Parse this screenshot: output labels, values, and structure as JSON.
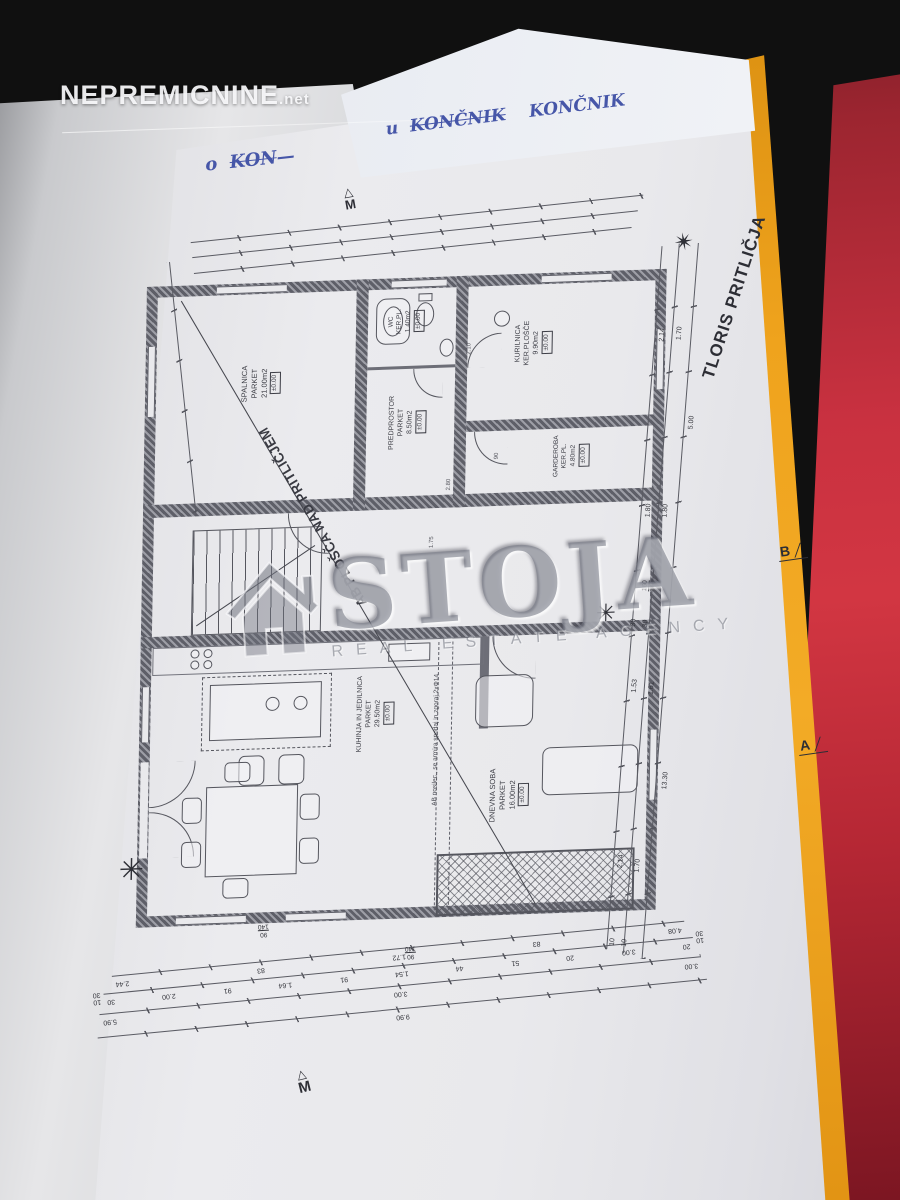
{
  "watermarks": {
    "nepremicnine": {
      "brand": "NEPREMICNINE",
      "suffix": ".net"
    },
    "stoja": {
      "brand": "STOJA",
      "subtitle": "REAL ESTATE AGENCY"
    }
  },
  "handwriting": {
    "mark1": "u",
    "word1_struck": "KONČNIK",
    "word2": "KONČNIK",
    "mark2": "o",
    "word3_struck": "KON"
  },
  "plan": {
    "title": "TLORIS PRITLIČJA",
    "diagonal_note": "AB PLOŠČA NAD PRITLIČJEM",
    "beam_note": "AB nosilec., se armira spodaj in zgoraj 2xΦ14",
    "north_symbol": "✴",
    "scale_letter": "M",
    "scale_triangle": "△",
    "section_b": "B",
    "section_a": "A",
    "rooms": [
      {
        "name": "SPALNICA",
        "finish": "PARKET",
        "area": "21.00m2",
        "level": "±0.00"
      },
      {
        "name": "WC",
        "finish": "KER.PL.",
        "area": "1.40m2",
        "level": "±0.00"
      },
      {
        "name": "PREDPROSTOR",
        "finish": "PARKET",
        "area": "8.50m2",
        "level": "±0.00"
      },
      {
        "name": "KURILNICA",
        "finish": "KER.PLOŠČE",
        "area": "9.90m2",
        "level": "±0.00"
      },
      {
        "name": "GARDEROBA",
        "finish": "KER.PL.",
        "area": "4.80m2",
        "level": "±0.00"
      },
      {
        "name": "KUHINJA IN JEDILNICA",
        "finish": "PARKET",
        "area": "29.50m2",
        "level": "±0.00"
      },
      {
        "name": "DNEVNA SOBA",
        "finish": "PARKET",
        "area": "16.00m2",
        "level": "±0.00"
      }
    ],
    "interior_dims": [
      "2.10",
      "90",
      "2.80",
      "1.75"
    ],
    "dims": {
      "bottom1": [
        "2.44",
        "83",
        "1.72",
        "83",
        "4.08"
      ],
      "bottom2": [
        "30",
        "2.00",
        "91",
        "1.64",
        "91",
        "1.54",
        "44",
        "51",
        "20",
        "3.00",
        "20"
      ],
      "bottom3": [
        "5.90",
        "3.00",
        "3.00"
      ],
      "bottom4": [
        "9.90"
      ],
      "bottom_caps_left": [
        "30",
        "10"
      ],
      "bottom_caps_right": [
        "30",
        "10"
      ],
      "right1": [
        "2.14",
        "1.80",
        "1.53",
        "2.14"
      ],
      "right2": [
        "1.70",
        "1.80",
        "1.61",
        "1.70"
      ],
      "right3": [
        "5.00",
        "13.30"
      ],
      "right_caps_top": [
        "30",
        "30"
      ],
      "right_caps_bottom": [
        "10",
        "10"
      ]
    },
    "window_markers": {
      "bottom_a": {
        "num": "90",
        "den": "140"
      },
      "bottom_b": {
        "num": "90",
        "den": "140"
      },
      "right": {
        "num": "160",
        "den": "140"
      }
    }
  }
}
